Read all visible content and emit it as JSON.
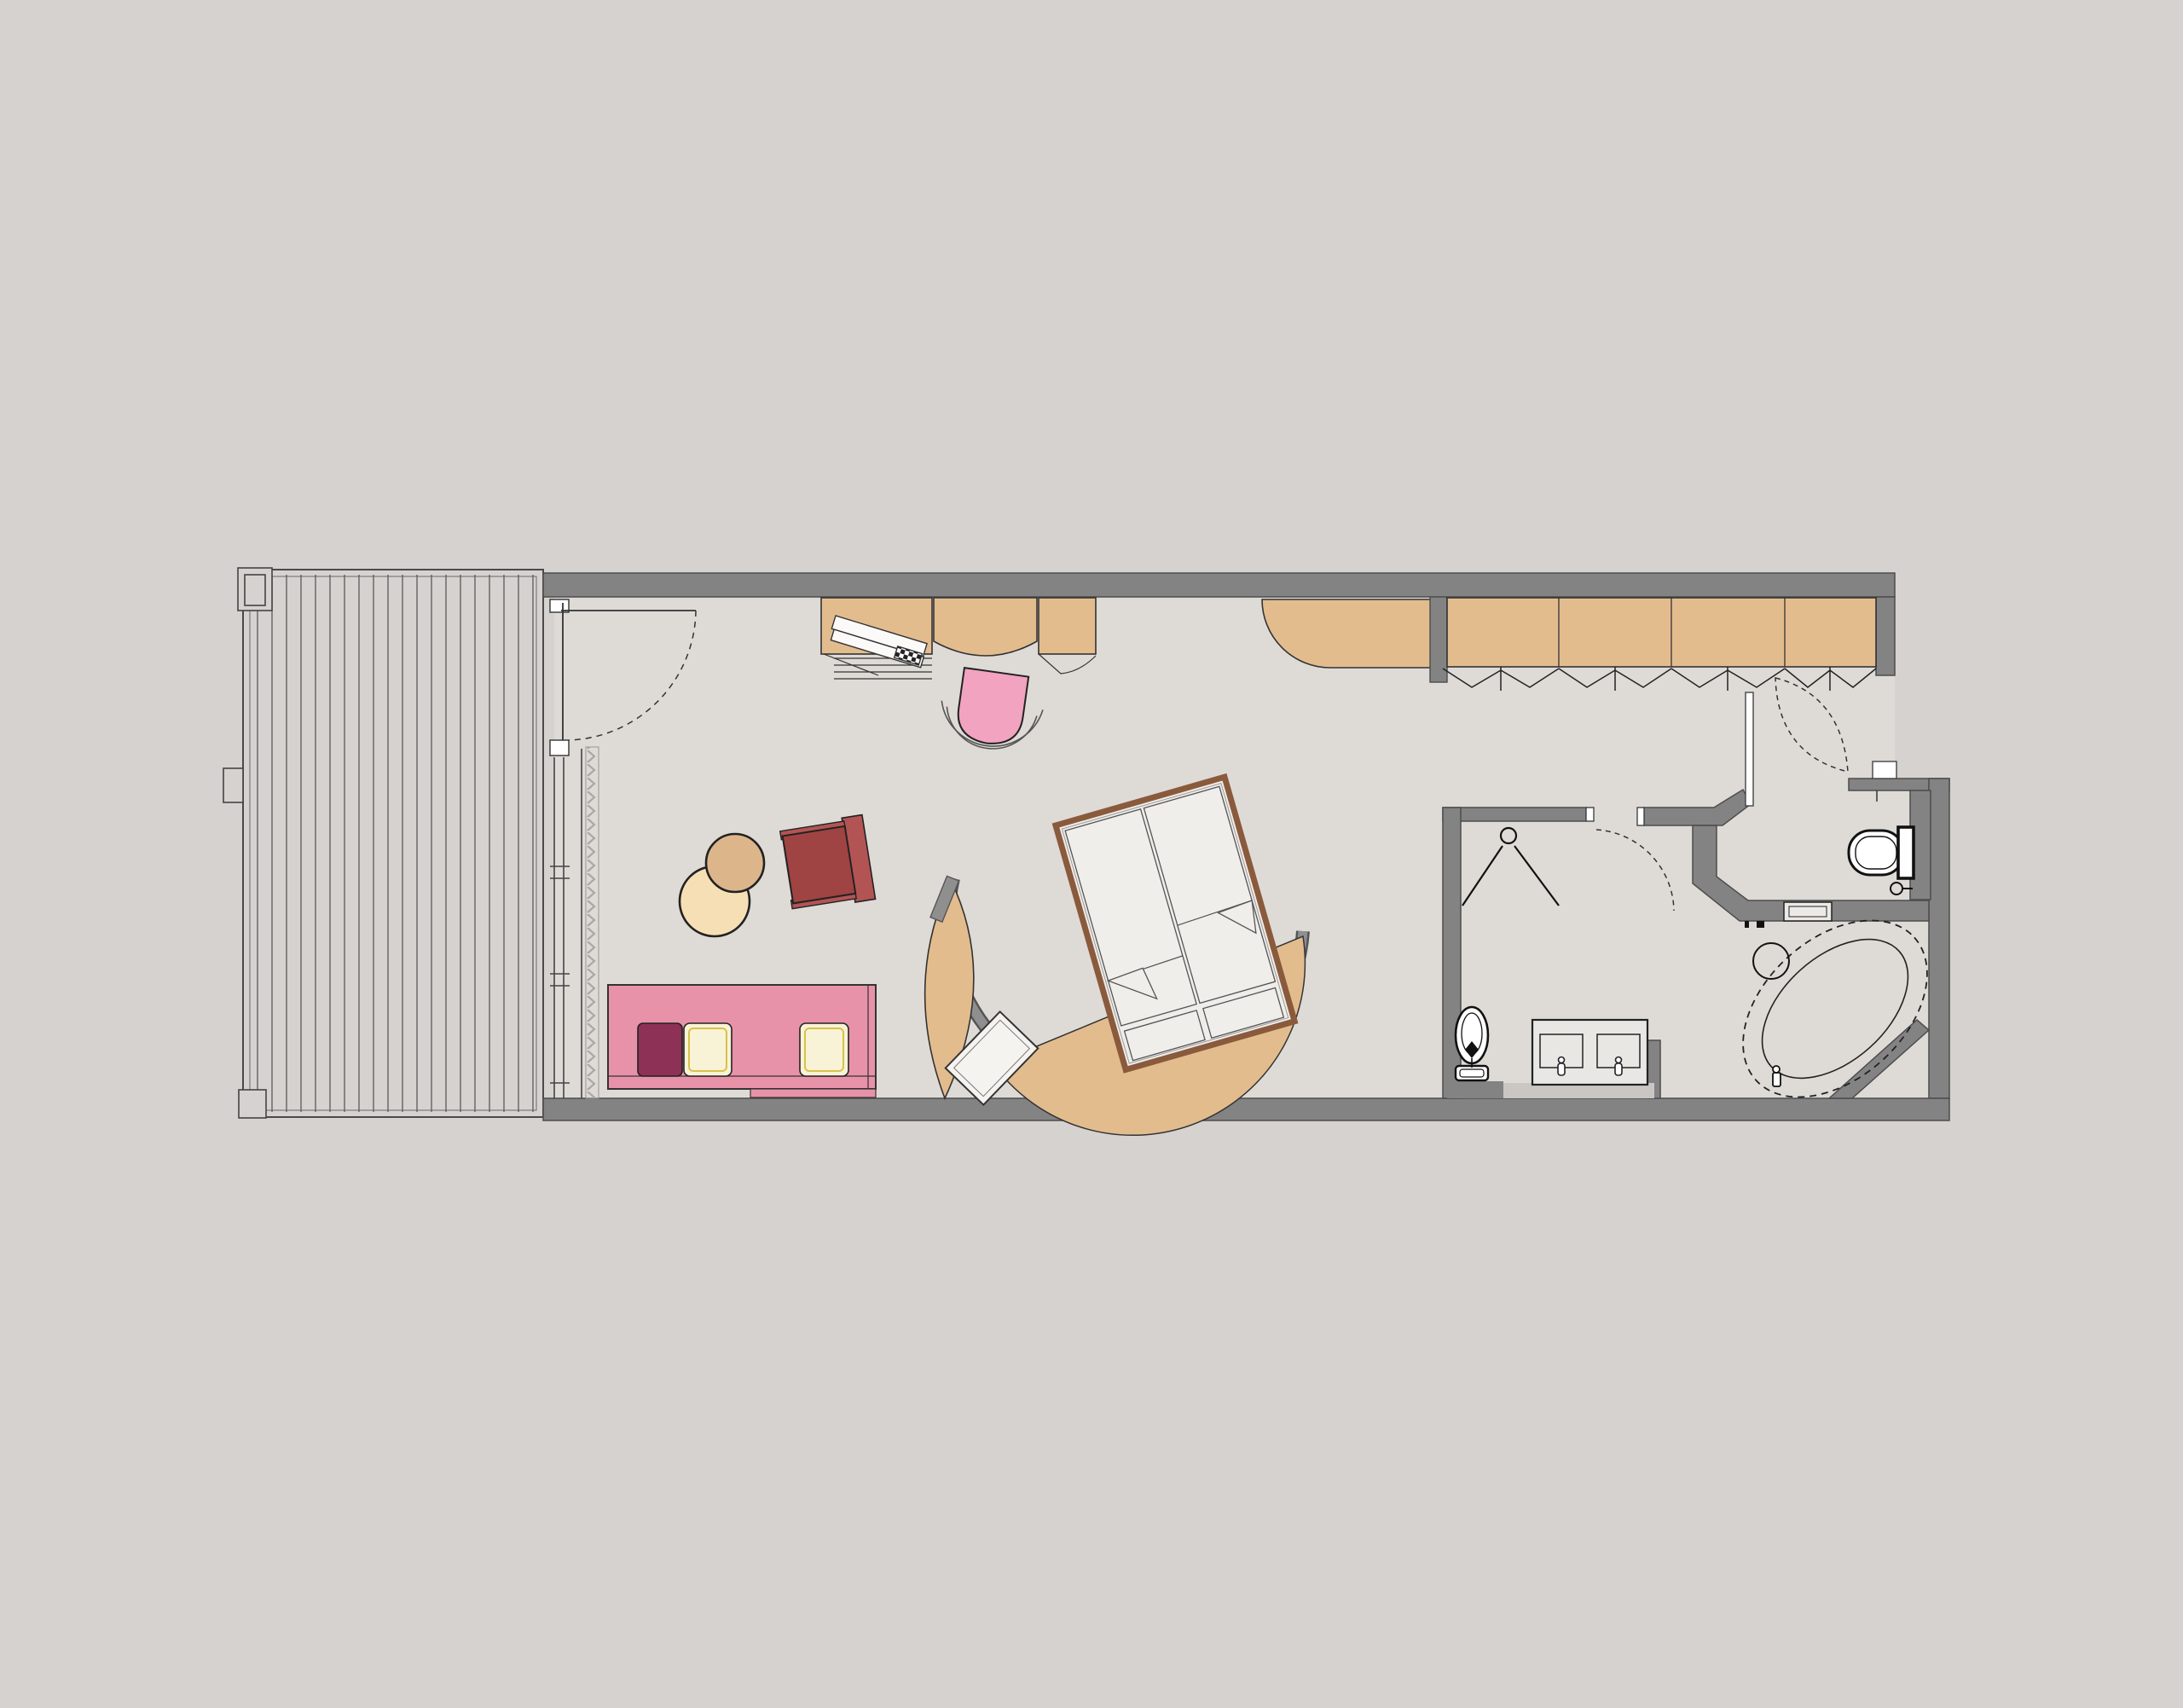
{
  "title": "hotel-room-floor-plan",
  "palette": {
    "bg_outer": "#d5d2cf",
    "floor": "#dedbd7",
    "wall": "#838383",
    "wall_edge": "#4d4d4d",
    "line": "#2b2b2b",
    "tan": "#e3bc8e",
    "tan_edge": "#333333",
    "sofa_pink": "#e892aa",
    "pillow_magenta": "#8e3156",
    "pillow_cream": "#f8f3d6",
    "pillow_cream_edge": "#d9c14c",
    "chair_pink": "#f1a3bf",
    "armchair_red": "#a04343",
    "armchair_red_light": "#b35454",
    "table_tan": "#dcb68a",
    "table_cream": "#f7dfb5",
    "bed_frame": "#8a5a3c",
    "bedding": "#efede9",
    "mattress": "#f0eeea",
    "arc_gray": "#8f8f8f",
    "white": "#f7f6f4",
    "black": "#111111",
    "ledge_light": "#c9c6c3"
  },
  "plan": {
    "areas": [
      "terrace",
      "living-area",
      "sleeping-area",
      "entry-vestibule",
      "bathroom",
      "wc",
      "bathtub-corner"
    ],
    "furniture": [
      "deck-boards",
      "terrace-door",
      "desk",
      "laptop",
      "desk-chair",
      "minibar-counter",
      "wardrobe",
      "side-table-pair",
      "armchair",
      "sofa",
      "sofa-pillows",
      "double-bed",
      "curved-bed-wall",
      "tv-panel",
      "shower",
      "shower-door",
      "bidet",
      "double-vanity",
      "toilet",
      "toilet-paper-holder",
      "bathtub",
      "stool",
      "shelf",
      "entry-door"
    ],
    "wardrobe_sections": 4,
    "sofa_pillow_count": 3,
    "vanity_sink_count": 2,
    "bed_mattress_count": 2
  }
}
